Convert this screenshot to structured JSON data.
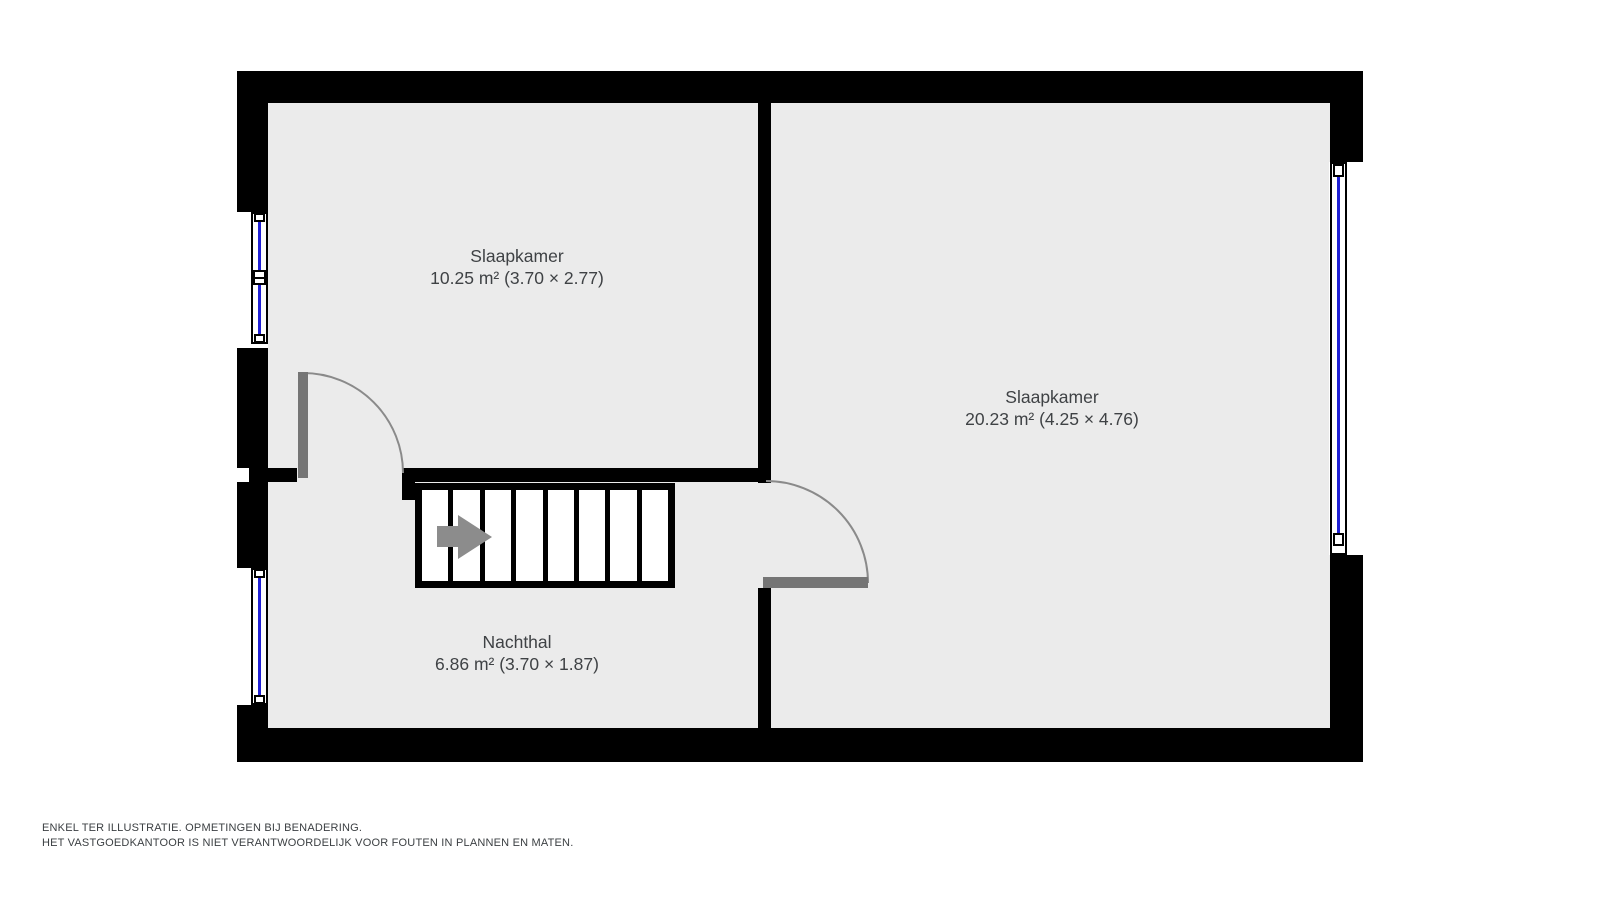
{
  "plan": {
    "type": "floorplan",
    "rooms": [
      {
        "name": "Slaapkamer",
        "size": "10.25 m² (3.70 × 2.77)"
      },
      {
        "name": "Slaapkamer",
        "size": "20.23 m² (4.25 × 4.76)"
      },
      {
        "name": "Nachthal",
        "size": "6.86 m² (3.70 × 1.87)"
      }
    ],
    "stairs": {
      "treads": 8,
      "direction_icon": "arrow-right"
    },
    "windows": 3,
    "doors": 2
  },
  "disclaimer": {
    "line1": "ENKEL TER ILLUSTRATIE. OPMETINGEN BIJ BENADERING.",
    "line2": "HET VASTGOEDKANTOOR IS NIET VERANTWOORDELIJK VOOR FOUTEN IN PLANNEN EN MATEN."
  },
  "colors": {
    "wall": "#000000",
    "floor": "#ebebeb",
    "window_glass": "#2020d6",
    "door": "#757575",
    "arrow": "#8c8c8c",
    "text": "#3f4245",
    "background": "#ffffff"
  }
}
